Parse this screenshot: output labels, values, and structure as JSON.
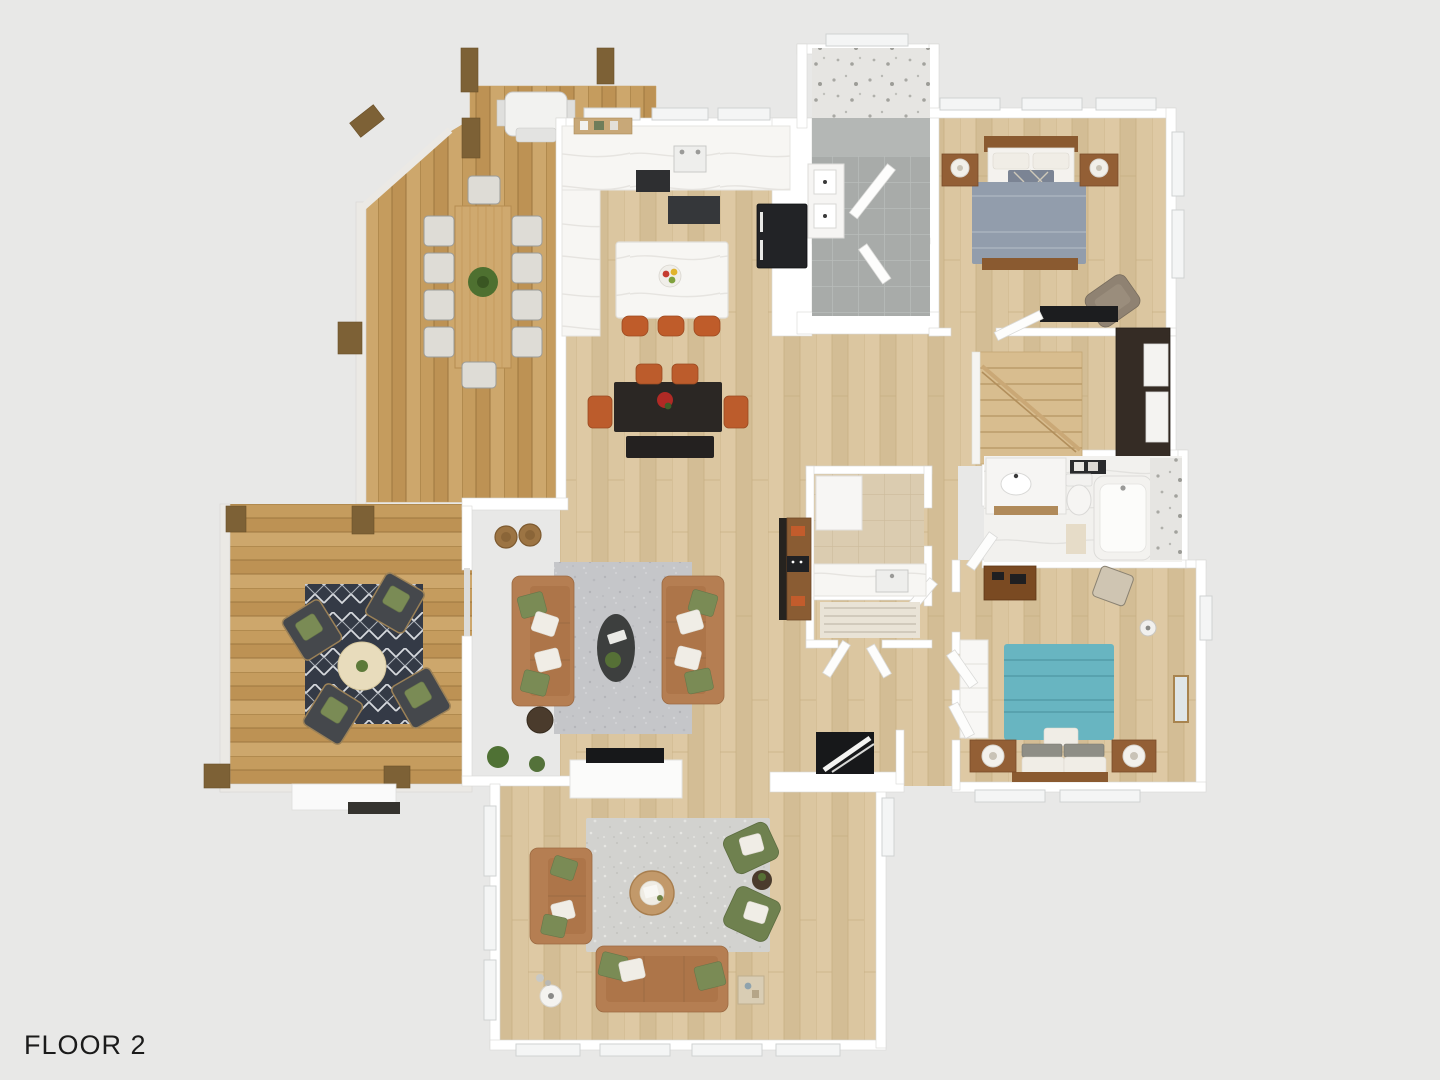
{
  "floor_label": "FLOOR 2",
  "colors": {
    "background": "#e8e8e7",
    "wall": "#ffffff",
    "wood_floor": "#d9c49d",
    "deck_wood": "#c9a166",
    "pergola_beam": "#7d6136",
    "counter_marble": "#f7f6f4",
    "stool_orange": "#bf5c2a",
    "dining_table": "#2b2724",
    "dining_chair": "#bc5c2c",
    "sofa_camel": "#b57e52",
    "pillow_green": "#7a8b55",
    "pillow_white": "#f0ede6",
    "living_rug": "#c5c6c9",
    "family_rug": "#d2d2cf",
    "coffee_table_dark": "#3d3f3e",
    "patio_chair": "#45484c",
    "patio_rug": "#343a46",
    "patio_table": "#e8dcbc",
    "bed1_duvet": "#929dac",
    "bed2_duvet": "#68b5c1",
    "nightstand_wood": "#935f35",
    "stair_wood": "#d8bd8f",
    "wardrobe_dark": "#352c25",
    "appliance_black": "#222326",
    "bath_tile_gray": "#a8aba9",
    "laundry_tile": "#dbccb0",
    "label_text": "#1b1b1b"
  }
}
